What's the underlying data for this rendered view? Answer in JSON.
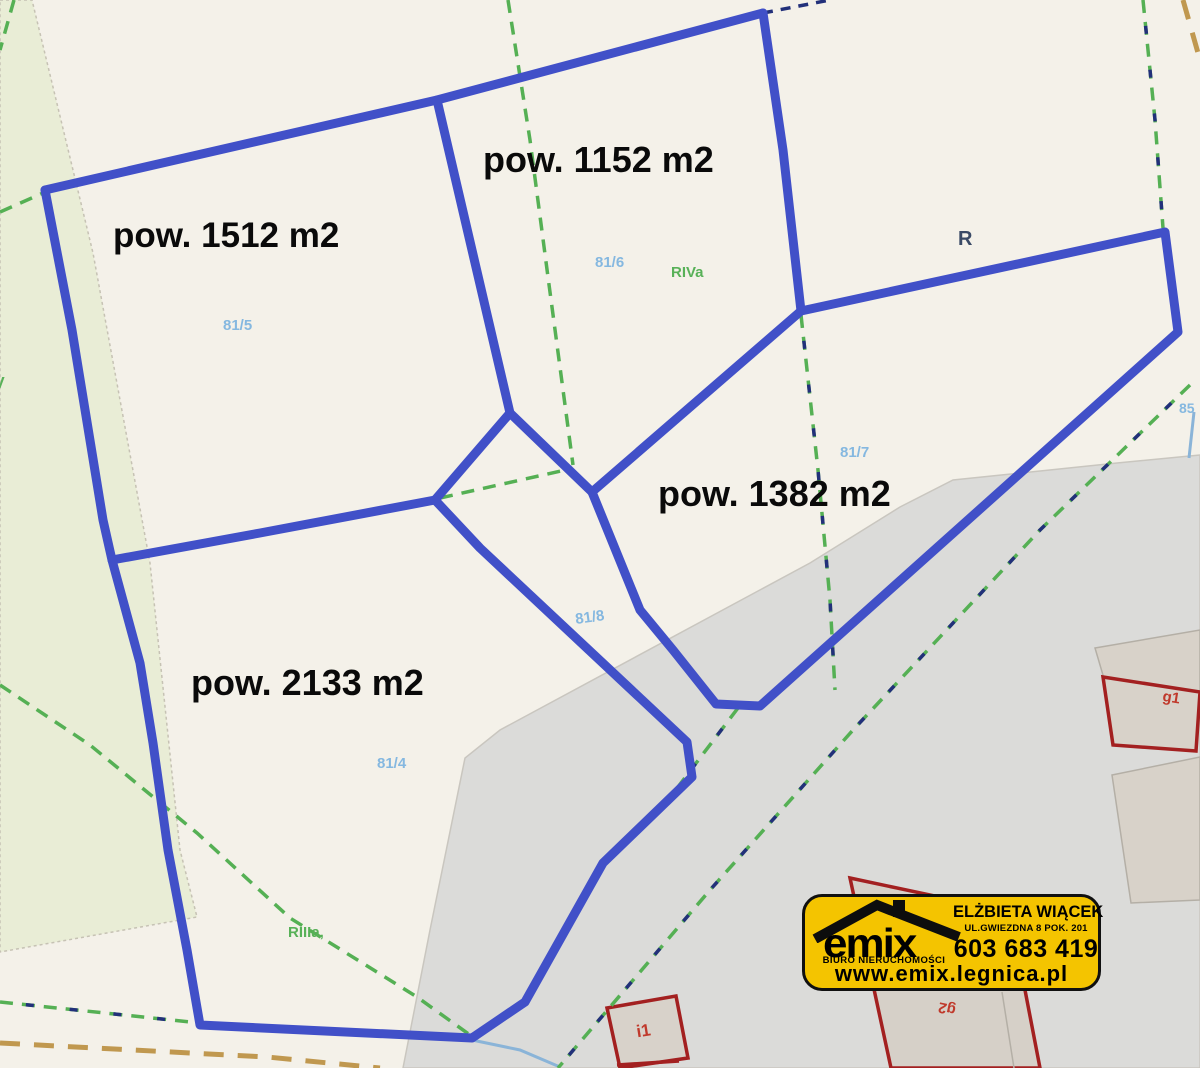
{
  "labels": {
    "area_1512": "pow. 1512 m2",
    "area_1152": "pow. 1152 m2",
    "area_1382": "pow. 1382 m2",
    "area_2133": "pow. 2133 m2",
    "parcel_81_5": "81/5",
    "parcel_81_6": "81/6",
    "parcel_81_7": "81/7",
    "parcel_81_8": "81/8",
    "parcel_81_4": "81/4",
    "parcel_85": "85",
    "soil_riva": "RIVa",
    "soil_riiia": "RIIIa,",
    "soil_v": "V",
    "soil_r": "R",
    "building_g1": "g1",
    "building_g2": "g2",
    "building_i1": "i1"
  },
  "logo": {
    "brand": "emix",
    "tagline": "BIURO NIERUCHOMOŚCI",
    "agent": "ELŻBIETA WIĄCEK",
    "address": "UL.GWIEZDNA 8 POK. 201",
    "phone": "603 683 419",
    "website": "www.emix.legnica.pl"
  },
  "colors": {
    "parcel_outline_blue": "#4150c8",
    "parcel_number_blue": "#85b8e0",
    "soil_class_green": "#58b158",
    "boundary_dash_green": "#55b054",
    "boundary_dash_navy": "#22307a",
    "dirt_road_tan": "#c0984f",
    "water_line_lightblue": "#8ab4d8",
    "building_outline_red": "#a32020",
    "road_gray": "#dbdbd9",
    "field_pale_green": "#e9edd6",
    "background_cream": "#f4f1e9",
    "logo_yellow": "#f4c400"
  }
}
